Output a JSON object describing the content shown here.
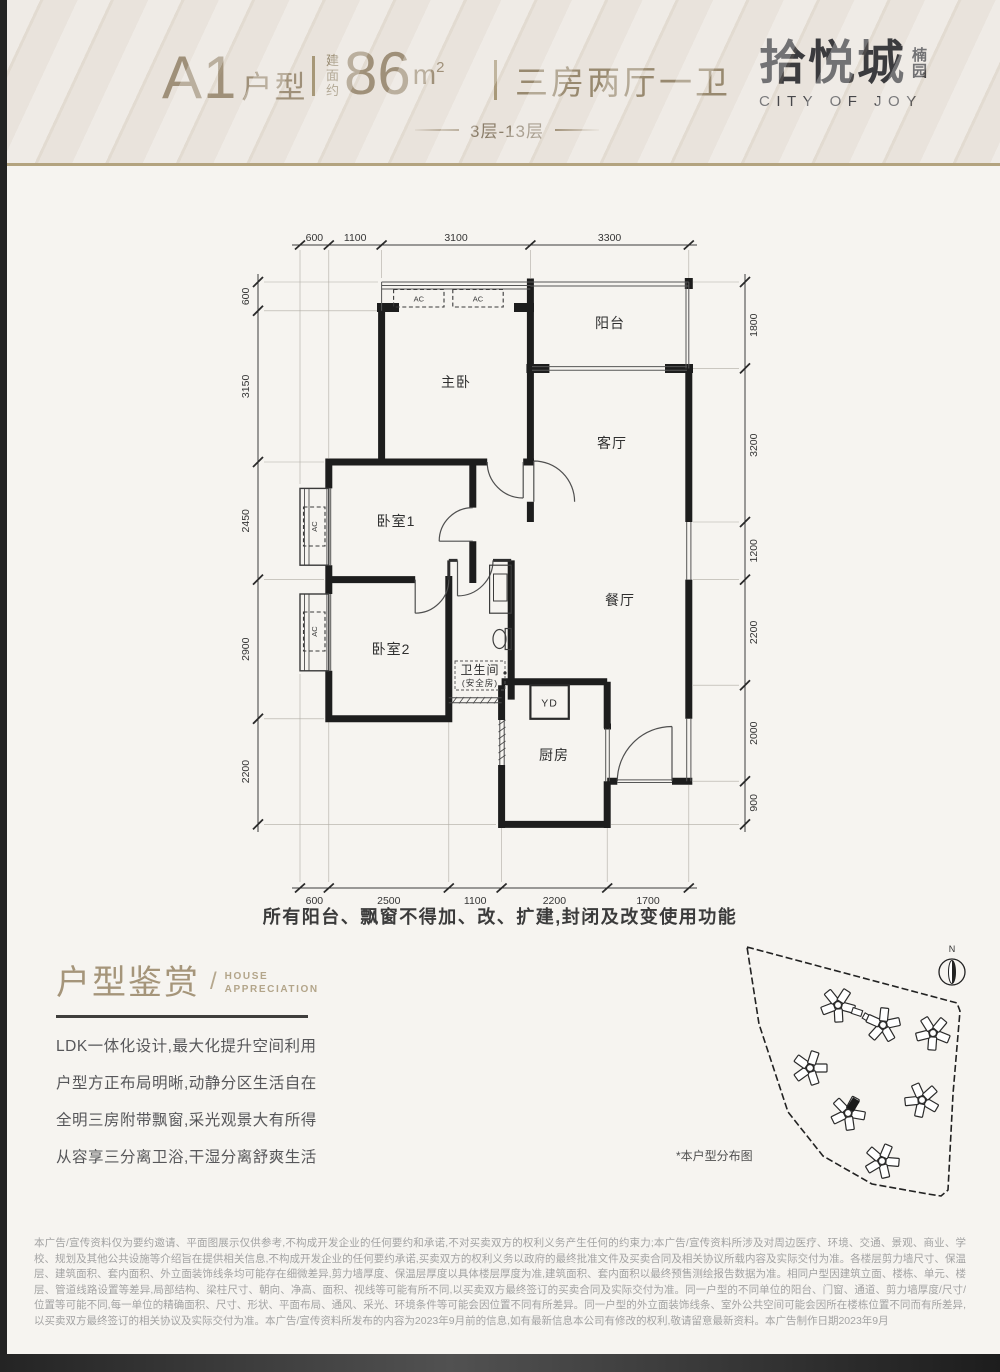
{
  "header": {
    "unit_code": "A1",
    "unit_label": "户型",
    "area_prefix": "建面约",
    "area_value": "86",
    "area_unit_base": "m",
    "area_unit_sup": "2",
    "rooms_summary": "三房两厅一卫",
    "floors_range": "3层-13层",
    "logo": {
      "name": "拾悦城",
      "sub": "楠园",
      "en": "CITY OF JOY"
    }
  },
  "plan": {
    "note": "所有阳台、飘窗不得加、改、扩建,封闭及改变使用功能",
    "rooms": {
      "master": "主卧",
      "balcony": "阳台",
      "living": "客厅",
      "dining": "餐厅",
      "bed1": "卧室1",
      "bed2": "卧室2",
      "bath": "卫生间",
      "bath_sub": "(安全房)",
      "kitchen": "厨房",
      "yd": "YD",
      "ac1": "AC",
      "ac2": "AC",
      "ac_bay1": "AC",
      "ac_bay2": "AC"
    },
    "dims": {
      "top": [
        "600",
        "1100",
        "3100",
        "3300"
      ],
      "bottom": [
        "600",
        "2500",
        "1100",
        "2200",
        "1700"
      ],
      "left": [
        "600",
        "3150",
        "2450",
        "2900",
        "2200"
      ],
      "right": [
        "1800",
        "3200",
        "1200",
        "2200",
        "2000",
        "900"
      ]
    }
  },
  "appreciation": {
    "title": "户型鉴赏",
    "slash": "/",
    "en_line1": "HOUSE",
    "en_line2": "APPRECIATION",
    "paragraphs": [
      "LDK一体化设计,最大化提升空间利用",
      "户型方正布局明晰,动静分区生活自在",
      "全明三房附带飘窗,采光观景大有所得",
      "从容享三分离卫浴,干湿分离舒爽生活"
    ]
  },
  "siteplan": {
    "caption": "*本户型分布图",
    "north_label": "N"
  },
  "disclaimer": {
    "text": "本广告/宣传资料仅为要约邀请、平面图展示仅供参考,不构成开发企业的任何要约和承诺,不对买卖双方的权利义务产生任何的约束力;本广告/宣传资料所涉及对周边医疗、环境、交通、景观、商业、学校、规划及其他公共设施等介绍旨在提供相关信息,不构成开发企业的任何要约承诺,买卖双方的权利义务以政府的最终批准文件及买卖合同及相关协议所载内容及实际交付为准。各楼层剪力墙尺寸、保温层、建筑面积、套内面积、外立面装饰线条均可能存在细微差异,剪力墙厚度、保温层厚度以具体楼层厚度为准,建筑面积、套内面积以最终预售测绘报告数据为准。相同户型因建筑立面、楼栋、单元、楼层、管道线路设置等差异,局部结构、梁柱尺寸、朝向、净高、面积、视线等可能有所不同,以买卖双方最终签订的买卖合同及实际交付为准。同一户型的不同单位的阳台、门窗、通道、剪力墙厚度/尺寸/位置等可能不同,每一单位的精确面积、尺寸、形状、平面布局、通风、采光、环境条件等可能会因位置不同有所差异。同一户型的外立面装饰线条、室外公共空间可能会因所在楼栋位置不同而有所差异,以买卖双方最终签订的相关协议及实际交付为准。本广告/宣传资料所发布的内容为2023年9月前的信息,如有最新信息本公司有修改的权利,敬请留意最新资料。本广告制作日期2023年9月"
  }
}
